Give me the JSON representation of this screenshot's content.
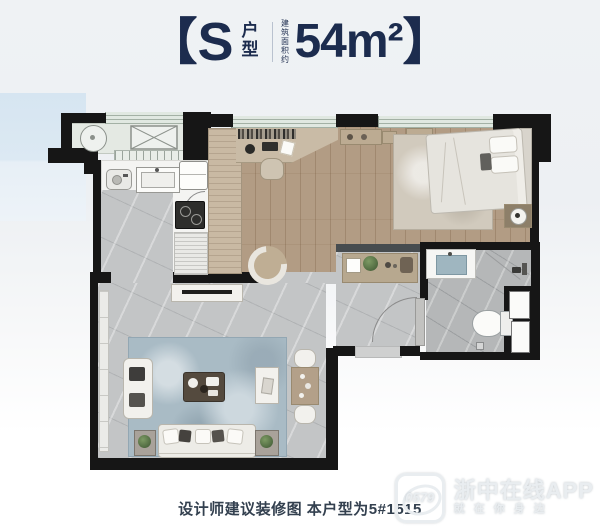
{
  "header": {
    "bracket_left": "【",
    "type_letter": "S",
    "type_label": "户型",
    "area_label": "建筑面积约",
    "area_value": "54m²",
    "bracket_right": "】"
  },
  "footer": {
    "caption": "设计师建议装修图 本户型为5#1515"
  },
  "watermark": {
    "logo_text": "0579",
    "app_name": "浙中在线APP",
    "slogan": "就在你身边"
  },
  "palette": {
    "title_navy": "#1c2c4e",
    "caption_slate": "#33404f",
    "wall_black": "#161616",
    "partition_gray": "#474c4f",
    "window_sage": "#e0e8e1",
    "wood_floor": "#b29c84",
    "tile_marble": "#c3c5c6",
    "bath_tile": "#b5b7b8",
    "rug_blue": "#a9bbc5",
    "accent_blue_block": "#d6e5f1",
    "watermark_white": "#e9edf0"
  }
}
